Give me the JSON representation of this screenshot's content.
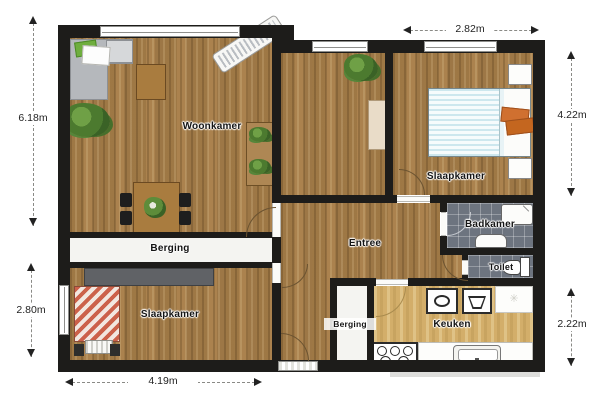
{
  "rooms": {
    "woonkamer": "Woonkamer",
    "slaapkamer_top": "Slaapkamer",
    "slaapkamer_bottom": "Slaapkamer",
    "entree": "Entree",
    "badkamer": "Badkamer",
    "toilet": "Toilet",
    "keuken": "Keuken",
    "berging_main": "Berging",
    "berging_small": "Berging"
  },
  "dimensions": {
    "top": "2.82m",
    "right_upper": "4.22m",
    "right_lower": "2.22m",
    "left_upper": "6.18m",
    "left_lower": "2.80m",
    "bottom": "4.19m"
  },
  "colors": {
    "wall": "#1d1c1a",
    "wood_floor": "#ab8350",
    "kitchen_floor": "#d3ae6a",
    "tile_floor": "#6d747f",
    "accent_orange": "#cf6a2c",
    "bed_blue_stripe": "#cde7ee",
    "bed_red_stripe": "#cc614a",
    "plant_green": "#4c7a2f"
  }
}
